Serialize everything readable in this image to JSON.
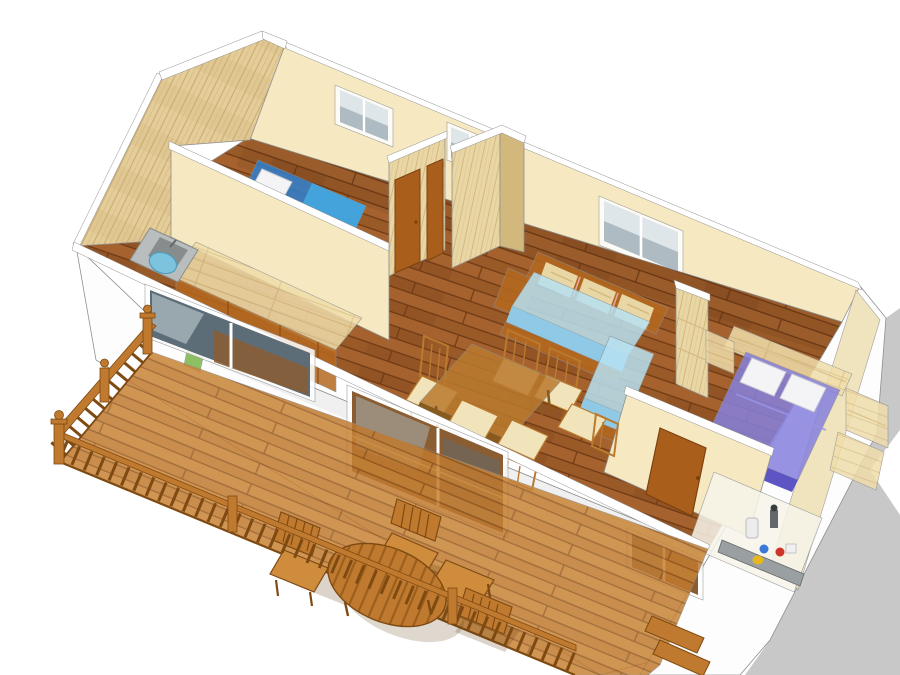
{
  "page": {
    "description": "Isometric 3D cutaway rendering of a mobile-home floor plan with a front timber deck terrace",
    "background": "#ffffff"
  },
  "colors": {
    "bg": "#ffffff",
    "shadow": "#c8c8c8",
    "outline": "#8f8f8f",
    "capWhite": "#ffffff",
    "facade": "#fdfdfd",
    "wallCream": "#f6e9c2",
    "wallCreamDark": "#eee0b4",
    "gableBase": "#e5cd99",
    "gableGrain": "#c9ac72",
    "panelBase": "#e9d6a5",
    "panelGrain": "#d3b87e",
    "floorBase": "#9a5a28",
    "floorLight": "#b26d35",
    "floorDark": "#6f3a14",
    "counterBase": "#f0ddaa",
    "counterGrain": "#d9bf85",
    "cabinet": "#b5691f",
    "cabinetDark": "#8e4d12",
    "door": "#a95f1b",
    "doorDark": "#7c420c",
    "deckBase": "#c07a2f",
    "deckLight": "#cf8c3d",
    "deckDark": "#8f5318",
    "railDark": "#7e4a12",
    "furnWood": "#b97a2e",
    "furnWoodDark": "#8a5a1c",
    "seatCream": "#f1e4bb",
    "bedBlue": "#2e80d0",
    "bedBlueLight": "#45aae2",
    "bedBlueDark": "#1d5ca2",
    "pillow": "#f4f4f6",
    "pillowShade": "#c9cbd4",
    "daybed": "#b7e1f2",
    "daybedDark": "#8fc9e6",
    "bedPurple": "#8680de",
    "bedPurpleDark": "#5d55c4",
    "blanketLine": "#9a94e6",
    "glassLight": "#dfe6ea",
    "glassMid": "#aebbc2",
    "glassDark": "#5d6d78",
    "glassBrown": "#8a5d33",
    "sink": "#b9bdbd",
    "sinkDark": "#878d8d",
    "basin": "#7ec3de",
    "basinDark": "#4f9cbc",
    "binGreen": "#7ab648",
    "eqRed": "#cc3527",
    "eqBlue": "#3c78d8",
    "eqYellow": "#e6b81e",
    "metal": "#63676a",
    "metalLight": "#9aa0a2",
    "shadeSoft": "#5e3a0f",
    "accentPink": "#e0a9a0"
  },
  "scene": {
    "building": {
      "rooms": [
        {
          "id": "bedroom-small",
          "furniture": [
            "blue-single-bed",
            "pillow"
          ]
        },
        {
          "id": "kitchen",
          "furniture": [
            "worktop",
            "base-cabinets",
            "sink-unit",
            "waste-bin"
          ]
        },
        {
          "id": "hallway",
          "furniture": [
            "wardrobe-panels",
            "door",
            "door"
          ]
        },
        {
          "id": "living-dining",
          "furniture": [
            "l-shaped-daybed-sofa",
            "dining-table",
            "dining-chairs-x6"
          ]
        },
        {
          "id": "bedroom-master",
          "furniture": [
            "purple-double-bed",
            "pillows-x2",
            "headboard-shelf",
            "side-shelves",
            "door"
          ]
        },
        {
          "id": "utility-compartment",
          "furniture": [
            "boiler",
            "gas-bottles"
          ]
        }
      ],
      "rear_windows": 3,
      "front_windows": 3
    },
    "deck": {
      "id": "timber-terrace",
      "furniture": [
        "oval-slatted-table",
        "deck-chairs-x3",
        "railing",
        "steps"
      ]
    }
  }
}
